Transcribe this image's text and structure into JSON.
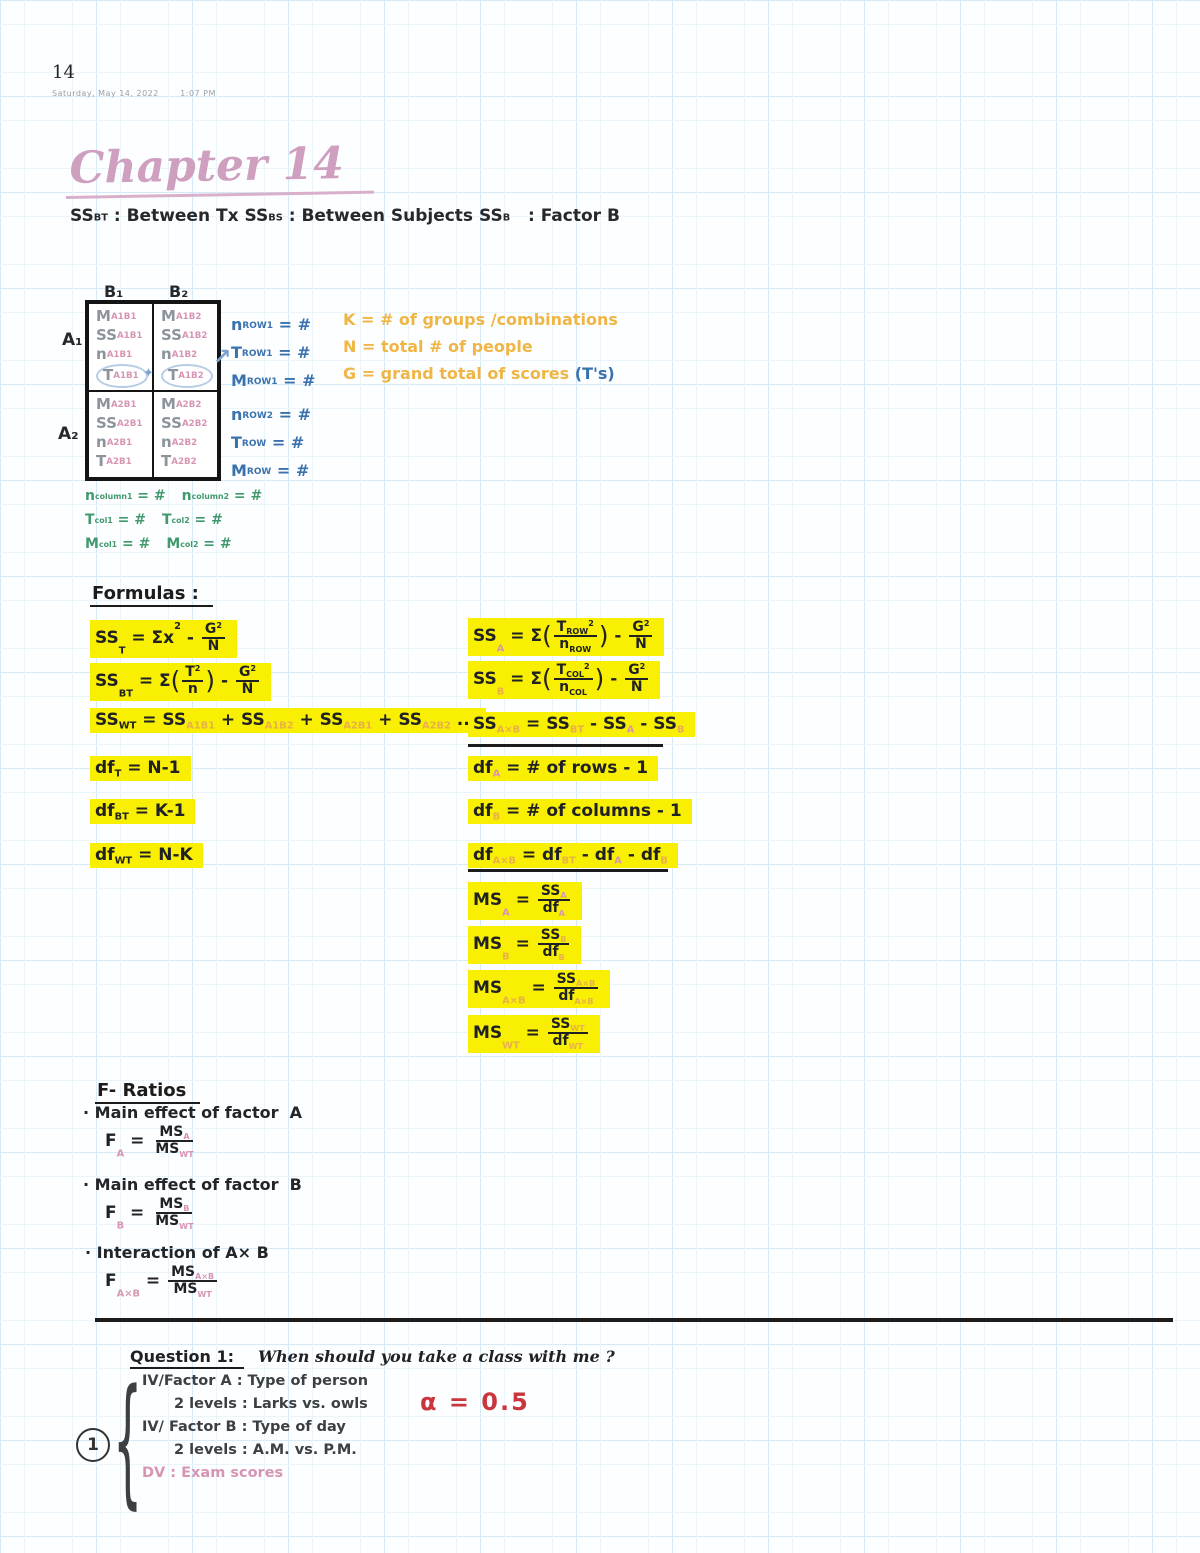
{
  "palette": {
    "grid_blue": "#d4eaf6",
    "ink_black": "#202124",
    "ink_gray": "#8d939c",
    "ink_pink": "#d795b4",
    "ink_blue": "#3a72ad",
    "ink_green": "#42996e",
    "ink_orange": "#efb545",
    "ink_red": "#c9363e",
    "highlight_yellow": "#f9ef03",
    "title_pink": "#cf9fc0"
  },
  "header": {
    "page_number": "14",
    "date": "Saturday, May 14, 2022",
    "time": "1:07 PM"
  },
  "title": "Chapter 14",
  "definitions": [
    [
      {
        "t": "SS"
      },
      {
        "sub": "BT"
      },
      {
        "t": " : Between Tx"
      }
    ],
    [
      {
        "t": "SS"
      },
      {
        "sub": "BS"
      },
      {
        "t": " : Between Subjects"
      }
    ],
    [
      {
        "t": "SS"
      },
      {
        "sub": "B"
      },
      {
        "t": "   : Factor B"
      }
    ]
  ],
  "matrix": {
    "col_headers": [
      "B₁",
      "B₂"
    ],
    "row_headers": [
      "A₁",
      "A₂"
    ],
    "cells": [
      [
        [
          {
            "t": "M"
          },
          {
            "sub": "A1B1"
          }
        ],
        [
          {
            "t": "SS"
          },
          {
            "sub": "A1B1"
          }
        ],
        [
          {
            "t": "n"
          },
          {
            "sub": "A1B1"
          }
        ],
        [
          {
            "t": "T"
          },
          {
            "sub": "A1B1"
          }
        ]
      ],
      [
        [
          {
            "t": "M"
          },
          {
            "sub": "A1B2"
          }
        ],
        [
          {
            "t": "SS"
          },
          {
            "sub": "A1B2"
          }
        ],
        [
          {
            "t": "n"
          },
          {
            "sub": "A1B2"
          }
        ],
        [
          {
            "t": "T"
          },
          {
            "sub": "A1B2"
          }
        ]
      ],
      [
        [
          {
            "t": "M"
          },
          {
            "sub": "A2B1"
          }
        ],
        [
          {
            "t": "SS"
          },
          {
            "sub": "A2B1"
          }
        ],
        [
          {
            "t": "n"
          },
          {
            "sub": "A2B1"
          }
        ],
        [
          {
            "t": "T"
          },
          {
            "sub": "A2B1"
          }
        ]
      ],
      [
        [
          {
            "t": "M"
          },
          {
            "sub": "A2B2"
          }
        ],
        [
          {
            "t": "SS"
          },
          {
            "sub": "A2B2"
          }
        ],
        [
          {
            "t": "n"
          },
          {
            "sub": "A2B2"
          }
        ],
        [
          {
            "t": "T"
          },
          {
            "sub": "A2B2"
          }
        ]
      ]
    ]
  },
  "row_notes": {
    "group1": [
      [
        {
          "t": "n"
        },
        {
          "sub": "ROW1"
        },
        {
          "t": " = #"
        }
      ],
      [
        {
          "t": "T"
        },
        {
          "sub": "ROW1"
        },
        {
          "t": " = #"
        }
      ],
      [
        {
          "t": "M"
        },
        {
          "sub": "ROW1"
        },
        {
          "t": " = #"
        }
      ]
    ],
    "group2": [
      [
        {
          "t": "n"
        },
        {
          "sub": "ROW2"
        },
        {
          "t": " = #"
        }
      ],
      [
        {
          "t": "T"
        },
        {
          "sub": "ROW"
        },
        {
          "t": " = #"
        }
      ],
      [
        {
          "t": "M"
        },
        {
          "sub": "ROW"
        },
        {
          "t": " = #"
        }
      ]
    ]
  },
  "legend": {
    "lines": [
      "K = # of groups /combinations",
      "N = total # of people",
      "G = grand total of scores"
    ],
    "tail": "(T's)"
  },
  "col_notes": [
    [
      [
        {
          "t": "n"
        },
        {
          "sub": "column1"
        },
        {
          "t": " = #"
        }
      ],
      [
        {
          "t": "n"
        },
        {
          "sub": "column2"
        },
        {
          "t": " = #"
        }
      ]
    ],
    [
      [
        {
          "t": "T"
        },
        {
          "sub": "col1"
        },
        {
          "t": " = #"
        }
      ],
      [
        {
          "t": "T"
        },
        {
          "sub": "col2"
        },
        {
          "t": " = #"
        }
      ]
    ],
    [
      [
        {
          "t": "M"
        },
        {
          "sub": "col1"
        },
        {
          "t": " = #"
        }
      ],
      [
        {
          "t": "M"
        },
        {
          "sub": "col2"
        },
        {
          "t": " = #"
        }
      ]
    ]
  ],
  "formulas": {
    "heading": "Formulas :",
    "left": [
      [
        {
          "t": "SS"
        },
        {
          "sub": "T"
        },
        {
          "t": " = Σx"
        },
        {
          "sup": "2"
        },
        {
          "t": " - "
        },
        {
          "frac": {
            "num": [
              {
                "t": "G"
              },
              {
                "sup": "2"
              }
            ],
            "den": [
              {
                "t": "N"
              }
            ]
          }
        }
      ],
      [
        {
          "t": "SS"
        },
        {
          "sub": "BT"
        },
        {
          "t": " = Σ"
        },
        {
          "p": "("
        },
        {
          "frac": {
            "num": [
              {
                "t": "T"
              },
              {
                "sup": "2"
              }
            ],
            "den": [
              {
                "t": "n"
              }
            ]
          }
        },
        {
          "p": ")"
        },
        {
          "t": " - "
        },
        {
          "frac": {
            "num": [
              {
                "t": "G"
              },
              {
                "sup": "2"
              }
            ],
            "den": [
              {
                "t": "N"
              }
            ]
          }
        }
      ],
      [
        {
          "t": "SS"
        },
        {
          "sub": "WT"
        },
        {
          "t": " = SS"
        },
        {
          "sub": "A1B1",
          "c": "lite"
        },
        {
          "t": " + SS"
        },
        {
          "sub": "A1B2",
          "c": "lite"
        },
        {
          "t": " + SS"
        },
        {
          "sub": "A2B1",
          "c": "lite"
        },
        {
          "t": " + SS"
        },
        {
          "sub": "A2B2",
          "c": "lite"
        },
        {
          "t": " ..."
        }
      ],
      [
        {
          "t": "df"
        },
        {
          "sub": "T"
        },
        {
          "t": " = N-1"
        }
      ],
      [
        {
          "t": "df"
        },
        {
          "sub": "BT"
        },
        {
          "t": " = K-1"
        }
      ],
      [
        {
          "t": "df"
        },
        {
          "sub": "WT"
        },
        {
          "t": " = N-K"
        }
      ]
    ],
    "right": [
      [
        {
          "t": "SS"
        },
        {
          "sub": "A",
          "c": "pink"
        },
        {
          "t": " = Σ"
        },
        {
          "p": "("
        },
        {
          "frac": {
            "num": [
              {
                "t": "T"
              },
              {
                "sub": "ROW"
              },
              {
                "sup": "2"
              }
            ],
            "den": [
              {
                "t": "n"
              },
              {
                "sub": "ROW"
              }
            ]
          }
        },
        {
          "p": ")"
        },
        {
          "t": " - "
        },
        {
          "frac": {
            "num": [
              {
                "t": "G"
              },
              {
                "sup": "2"
              }
            ],
            "den": [
              {
                "t": "N"
              }
            ]
          }
        }
      ],
      [
        {
          "t": "SS"
        },
        {
          "sub": "B",
          "c": "lite"
        },
        {
          "t": " = Σ"
        },
        {
          "p": "("
        },
        {
          "frac": {
            "num": [
              {
                "t": "T"
              },
              {
                "sub": "COL"
              },
              {
                "sup": "2"
              }
            ],
            "den": [
              {
                "t": "n"
              },
              {
                "sub": "COL"
              }
            ]
          }
        },
        {
          "p": ")"
        },
        {
          "t": " - "
        },
        {
          "frac": {
            "num": [
              {
                "t": "G"
              },
              {
                "sup": "2"
              }
            ],
            "den": [
              {
                "t": "N"
              }
            ]
          }
        }
      ],
      [
        {
          "t": "SS"
        },
        {
          "sub": "A×B",
          "c": "lite"
        },
        {
          "t": " = SS"
        },
        {
          "sub": "BT",
          "c": "lite"
        },
        {
          "t": " - SS"
        },
        {
          "sub": "A",
          "c": "pink"
        },
        {
          "t": " - SS"
        },
        {
          "sub": "B",
          "c": "lite"
        }
      ],
      [
        {
          "t": "df"
        },
        {
          "sub": "A",
          "c": "pink"
        },
        {
          "t": " = # of rows - 1"
        }
      ],
      [
        {
          "t": "df"
        },
        {
          "sub": "B",
          "c": "lite"
        },
        {
          "t": " = # of columns - 1"
        }
      ],
      [
        {
          "t": "df"
        },
        {
          "sub": "A×B",
          "c": "lite"
        },
        {
          "t": " = df"
        },
        {
          "sub": "BT",
          "c": "lite"
        },
        {
          "t": " - df"
        },
        {
          "sub": "A",
          "c": "pink"
        },
        {
          "t": " - df"
        },
        {
          "sub": "B",
          "c": "lite"
        }
      ],
      [
        {
          "t": "MS"
        },
        {
          "sub": "A",
          "c": "pink"
        },
        {
          "t": " = "
        },
        {
          "frac": {
            "num": [
              {
                "t": "SS"
              },
              {
                "sub": "A",
                "c": "pink"
              }
            ],
            "den": [
              {
                "t": "df"
              },
              {
                "sub": "A",
                "c": "pink"
              }
            ]
          }
        }
      ],
      [
        {
          "t": "MS"
        },
        {
          "sub": "B",
          "c": "lite"
        },
        {
          "t": " = "
        },
        {
          "frac": {
            "num": [
              {
                "t": "SS"
              },
              {
                "sub": "B",
                "c": "lite"
              }
            ],
            "den": [
              {
                "t": "df"
              },
              {
                "sub": "B",
                "c": "lite"
              }
            ]
          }
        }
      ],
      [
        {
          "t": "MS"
        },
        {
          "sub": "A×B",
          "c": "lite"
        },
        {
          "t": " = "
        },
        {
          "frac": {
            "num": [
              {
                "t": "SS"
              },
              {
                "sub": "A×B",
                "c": "lite"
              }
            ],
            "den": [
              {
                "t": "df"
              },
              {
                "sub": "A×B",
                "c": "lite"
              }
            ]
          }
        }
      ],
      [
        {
          "t": "MS"
        },
        {
          "sub": "WT",
          "c": "lite"
        },
        {
          "t": " = "
        },
        {
          "frac": {
            "num": [
              {
                "t": "SS"
              },
              {
                "sub": "WT",
                "c": "lite"
              }
            ],
            "den": [
              {
                "t": "df"
              },
              {
                "sub": "WT",
                "c": "lite"
              }
            ]
          }
        }
      ]
    ]
  },
  "f_ratios": {
    "heading": "F- Ratios",
    "items": [
      {
        "label": "· Main effect of factor  A",
        "formula": [
          {
            "t": "F"
          },
          {
            "sub": "A",
            "c": "pink"
          },
          {
            "t": " = "
          },
          {
            "frac": {
              "num": [
                {
                  "t": "MS"
                },
                {
                  "sub": "A",
                  "c": "pink"
                }
              ],
              "den": [
                {
                  "t": "MS"
                },
                {
                  "sub": "WT",
                  "c": "pink"
                }
              ]
            }
          }
        ]
      },
      {
        "label": "· Main effect of factor  B",
        "formula": [
          {
            "t": "F"
          },
          {
            "sub": "B",
            "c": "pink"
          },
          {
            "t": " = "
          },
          {
            "frac": {
              "num": [
                {
                  "t": "MS"
                },
                {
                  "sub": "B",
                  "c": "pink"
                }
              ],
              "den": [
                {
                  "t": "MS"
                },
                {
                  "sub": "WT",
                  "c": "pink"
                }
              ]
            }
          }
        ]
      },
      {
        "label": "· Interaction of A× B",
        "formula": [
          {
            "t": "F"
          },
          {
            "sub": "A×B",
            "c": "pink"
          },
          {
            "t": " = "
          },
          {
            "frac": {
              "num": [
                {
                  "t": "MS"
                },
                {
                  "sub": "A×B",
                  "c": "pink"
                }
              ],
              "den": [
                {
                  "t": "MS"
                },
                {
                  "sub": "WT",
                  "c": "pink"
                }
              ]
            }
          }
        ]
      }
    ]
  },
  "question": {
    "heading": "Question 1:",
    "text": "When should you take a class with me ?",
    "badge": "1",
    "alpha": "α = 0.5",
    "lines": [
      {
        "text": "IV/Factor A : Type of person"
      },
      {
        "text": "2 levels : Larks vs. owls"
      },
      {
        "text": "IV/ Factor B : Type of day"
      },
      {
        "text": "2 levels : A.M. vs. P.M."
      },
      {
        "text": "DV : Exam scores"
      }
    ]
  }
}
